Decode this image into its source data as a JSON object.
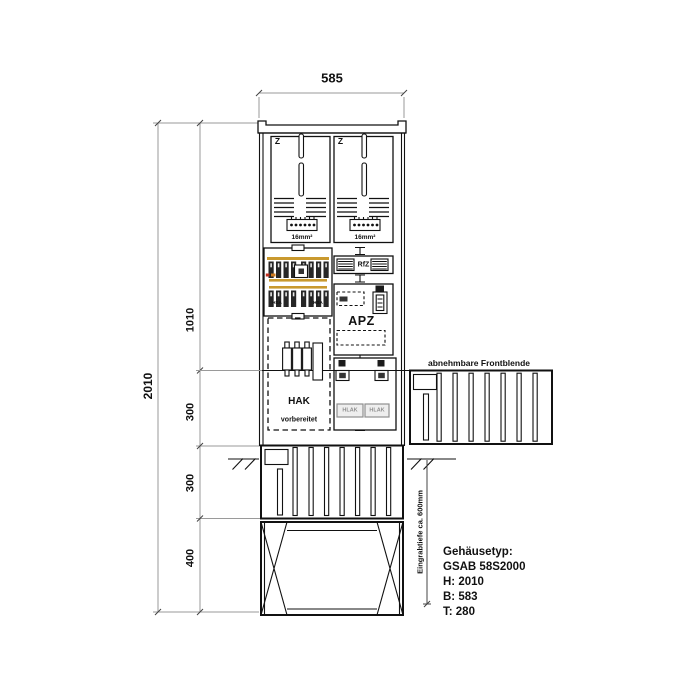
{
  "dimensions": {
    "width": "585",
    "total_height": "2010",
    "segments": [
      "1010",
      "300",
      "300",
      "400"
    ],
    "burial_depth": "Eingrabtiefe ca. 600mm"
  },
  "cabinet": {
    "meter_fields": [
      {
        "z": "Z",
        "wire": "16mm²"
      },
      {
        "z": "Z",
        "wire": "16mm²"
      }
    ],
    "hsa_left": "HSA",
    "hsa_right": "HSA",
    "rfz": "RfZ",
    "apz": "APZ",
    "hak": "HAK",
    "hak_note": "vorbereitet",
    "hlak_left": "HLAK",
    "hlak_right": "HLAK",
    "front_panel_note": "abnehmbare Frontblende"
  },
  "spec": {
    "heading": "Gehäusetyp:",
    "model": "GSAB 58S2000",
    "height": "H: 2010",
    "width": "B: 583",
    "depth": "T: 280"
  },
  "colors": {
    "busbar": "#c9992e",
    "busbar2": "#cf7b1e",
    "detail_red": "#c03020",
    "muted": "#8f8f8f"
  }
}
